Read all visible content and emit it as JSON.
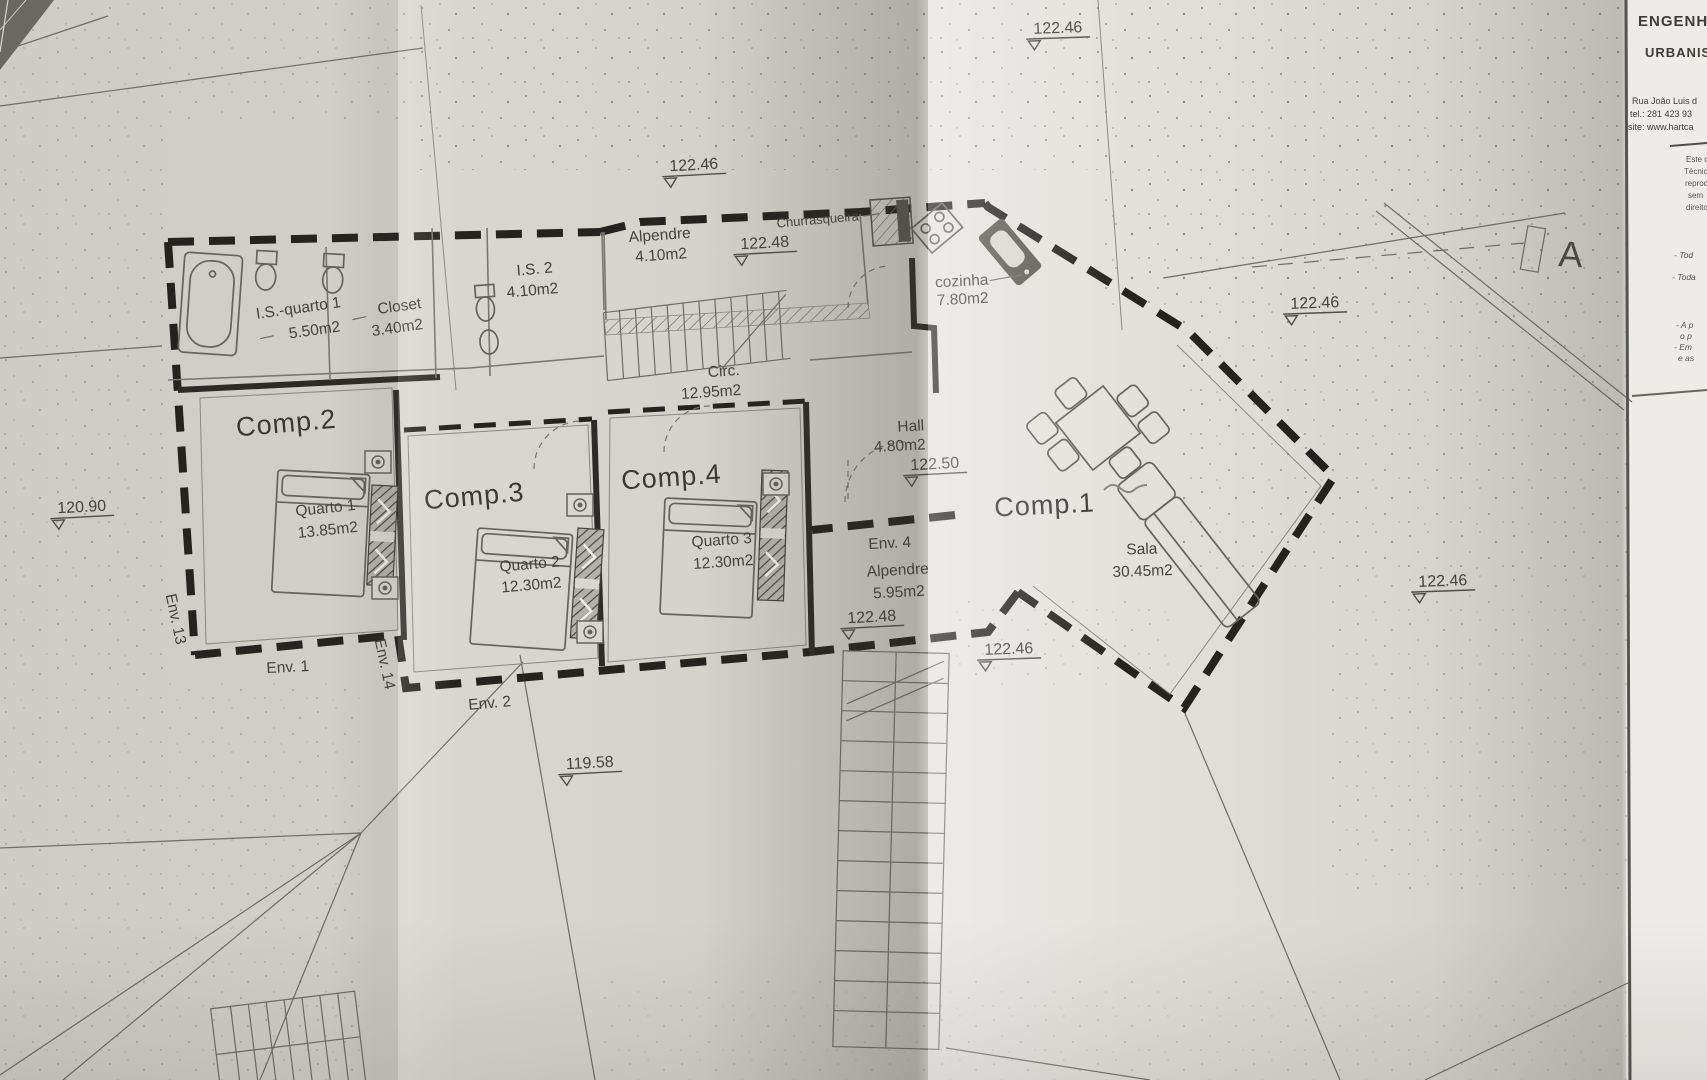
{
  "colors": {
    "paper": "#d8d5d0",
    "paper_light": "#ebe9e5",
    "ink": "#44423d",
    "wall": "#24231f"
  },
  "rooms": {
    "comp1": {
      "name": "Comp.1"
    },
    "comp2": {
      "name": "Comp.2"
    },
    "comp3": {
      "name": "Comp.3"
    },
    "comp4": {
      "name": "Comp.4"
    },
    "quarto1": {
      "name": "Quarto 1",
      "area": "13.85m2"
    },
    "quarto2": {
      "name": "Quarto 2",
      "area": "12.30m2"
    },
    "quarto3": {
      "name": "Quarto 3",
      "area": "12.30m2"
    },
    "sala": {
      "name": "Sala",
      "area": "30.45m2"
    },
    "cozinha": {
      "name": "cozinha",
      "area": "7.80m2"
    },
    "circ": {
      "name": "Circ.",
      "area": "12.95m2"
    },
    "hall": {
      "name": "Hall",
      "area": "4.80m2"
    },
    "alpendre_top": {
      "name": "Alpendre",
      "area": "4.10m2"
    },
    "alpendre_env4": {
      "name": "Alpendre",
      "area": "5.95m2"
    },
    "is2": {
      "name": "I.S. 2",
      "area": "4.10m2"
    },
    "closet": {
      "name": "Closet",
      "area": "3.40m2"
    },
    "is_quarto1": {
      "name": "I.S.-quarto 1",
      "area": "5.50m2"
    },
    "churrasqueira": {
      "name": "Churrasqueira"
    }
  },
  "env_labels": {
    "env1": "Env. 1",
    "env2": "Env. 2",
    "env4": "Env. 4",
    "env13": "Env. 13",
    "env14": "Env. 14"
  },
  "elevation_markers": [
    "122.46",
    "122.46",
    "122.48",
    "122.46",
    "122.50",
    "122.48",
    "122.46",
    "122.46",
    "119.58",
    "120.90"
  ],
  "section_marker": {
    "label": "A"
  },
  "title_block": {
    "company_line1": "ENGENHA",
    "company_line2": "URBANIS",
    "address": "Rua João Luis d",
    "phone": "tel.: 281 423 93",
    "website": "site: www.hartca",
    "notes": [
      "Este d",
      "Técnico",
      "reprod",
      "sem",
      "direito"
    ],
    "clauses": [
      "- Tod",
      "- Toda",
      "- A p",
      "o p",
      "- Em",
      "e as"
    ]
  }
}
